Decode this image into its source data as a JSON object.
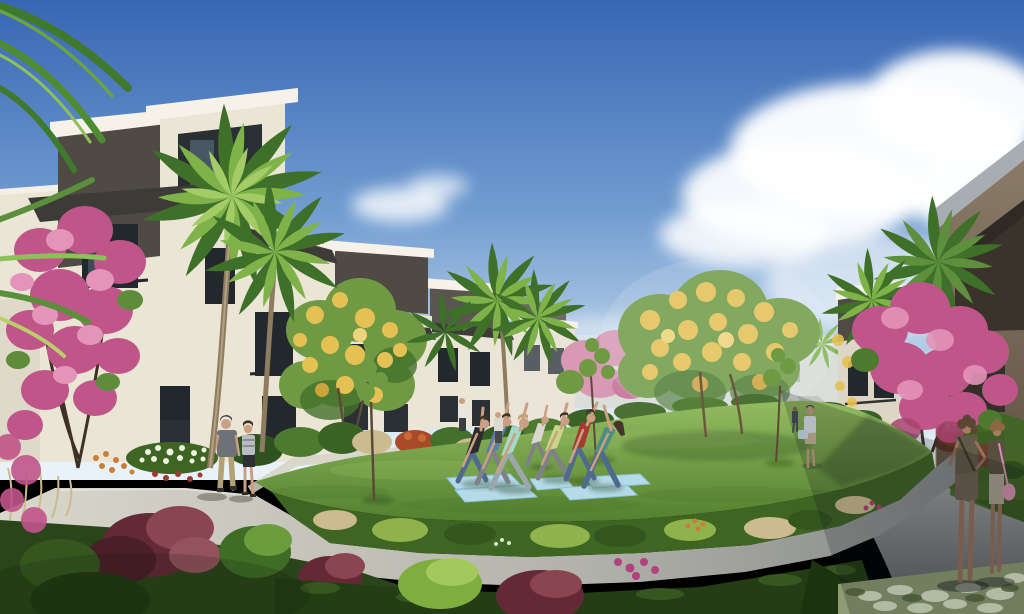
{
  "scene": {
    "type": "architectural-rendering",
    "description": "Sunny 3D rendering of a modern residential courtyard: a yoga group in triangle pose on light-blue mats on an oval lawn, ringed by concrete paths, pink crape myrtle trees, yellow flowering trees and palms, with three-story cream buildings with dark gray tower accents under a blue sky with a large cumulus cloud on the right.",
    "time_of_day": "midday",
    "people": {
      "yoga_participants": 7,
      "yoga_mats": 5,
      "walking_couple": 2,
      "women_standing_right_path": 2,
      "walkers_right_path": 2,
      "bystanders_near_buildings": 2
    },
    "landscape": {
      "lawn": "large oval central lawn",
      "paths": [
        "curved ring promenade",
        "left walkway to buildings",
        "right straight path in shadow"
      ],
      "trees": [
        "pink crape myrtle left foreground",
        "pink crape myrtle right",
        "distant pink tree",
        "large yellow flowering tree center",
        "yellow flowering tree left-center",
        "multiple palms",
        "three young lawn trees"
      ],
      "planting": [
        "burgundy shrubs",
        "white flower bed",
        "orange flowers",
        "ornamental tan grasses",
        "dark clipped hedge",
        "variegated groundcover bottom right",
        "magenta accents"
      ]
    },
    "buildings": {
      "left_row": "three-story cream stucco buildings with white parapet caps, dark gray stair towers, dark flat canopies and dark-framed windows, receding into distance",
      "center_distance": "low hazy apartment blocks",
      "right": "tan three-story building in shadow with gray sloped roof cap"
    }
  },
  "colors": {
    "sky_top": "#3866b3",
    "sky_mid": "#6f9bd0",
    "sky_low": "#b9d1e8",
    "sky_horizon": "#e9f2f8",
    "cloud_white": "#ffffff",
    "wall_cream": "#ebe5d6",
    "wall_cream_shade": "#d7d0bf",
    "parapet_white": "#f6f2e9",
    "trim_dark": "#4f4a43",
    "canopy_dark": "#3c3b37",
    "window_dark": "#23282d",
    "window_glass": "#50616f",
    "distant_facade": "#cdd0c7",
    "right_roof_gray": "#a7adb2",
    "right_wall_tan": "#8a7a67",
    "right_wall_dark": "#3a332b",
    "right_mid_wall": "#ddd6c7",
    "palm_green_dark": "#3e7029",
    "palm_green_light": "#7fb34a",
    "palm_trunk": "#8d7c60",
    "pink_bloom": "#c05589",
    "pink_bloom_light": "#e394b8",
    "pink_bloom_distant": "#d899b4",
    "yellow_bloom": "#e5c153",
    "canopy_green": "#6f9a43",
    "canopy_green_dark": "#44702c",
    "lawn_back": "#95bd62",
    "lawn_front": "#527f2e",
    "path_sunlit": "#dad7cc",
    "path_mid": "#b4b4ac",
    "path_shaded": "#7e8284",
    "path_right_top": "#c6c9c5",
    "path_right_bottom": "#66696c",
    "bed_green": "#3f6523",
    "bush_green_light": "#8fb24c",
    "grass_tan": "#cbbb8e",
    "hedge_dark": "#243d15",
    "shrub_burgundy": "#632a35",
    "shrub_burgundy_light": "#8a4550",
    "groundcover_base": "#8d9c72",
    "groundcover_light": "#dde5c9",
    "mat_blue": "#b5dbe9",
    "skin": "#c9a084",
    "skin_shaded": "#96705a",
    "hair_dark": "#43352a",
    "hair_light": "#c3a376",
    "shirt_black": "#2b2b2e",
    "shirt_slate": "#5d7da4",
    "shirt_mint": "#a6d8c6",
    "shirt_lime": "#c6d789",
    "shirt_red": "#a53a30",
    "shirt_teal": "#4e8e80",
    "shirt_pale": "#d8d8cf",
    "denim_blue": "#4f6a8e",
    "pants_gray": "#7e8287",
    "man_shirt_gray": "#6e7276",
    "khaki": "#b3a176",
    "woman_top_striped": "#b9bcc0",
    "shorts_black": "#2d2f33",
    "olive_top": "#625a48",
    "olive_bottom": "#6e6052",
    "bag_pink": "#d490ac",
    "walker_top": "#dfe8ee",
    "walker_skirt": "#c9b89a",
    "accent_orange": "#cd7d36",
    "accent_white": "#f0f3e4",
    "accent_magenta": "#b2417c",
    "branch_brown": "#3f3026"
  }
}
